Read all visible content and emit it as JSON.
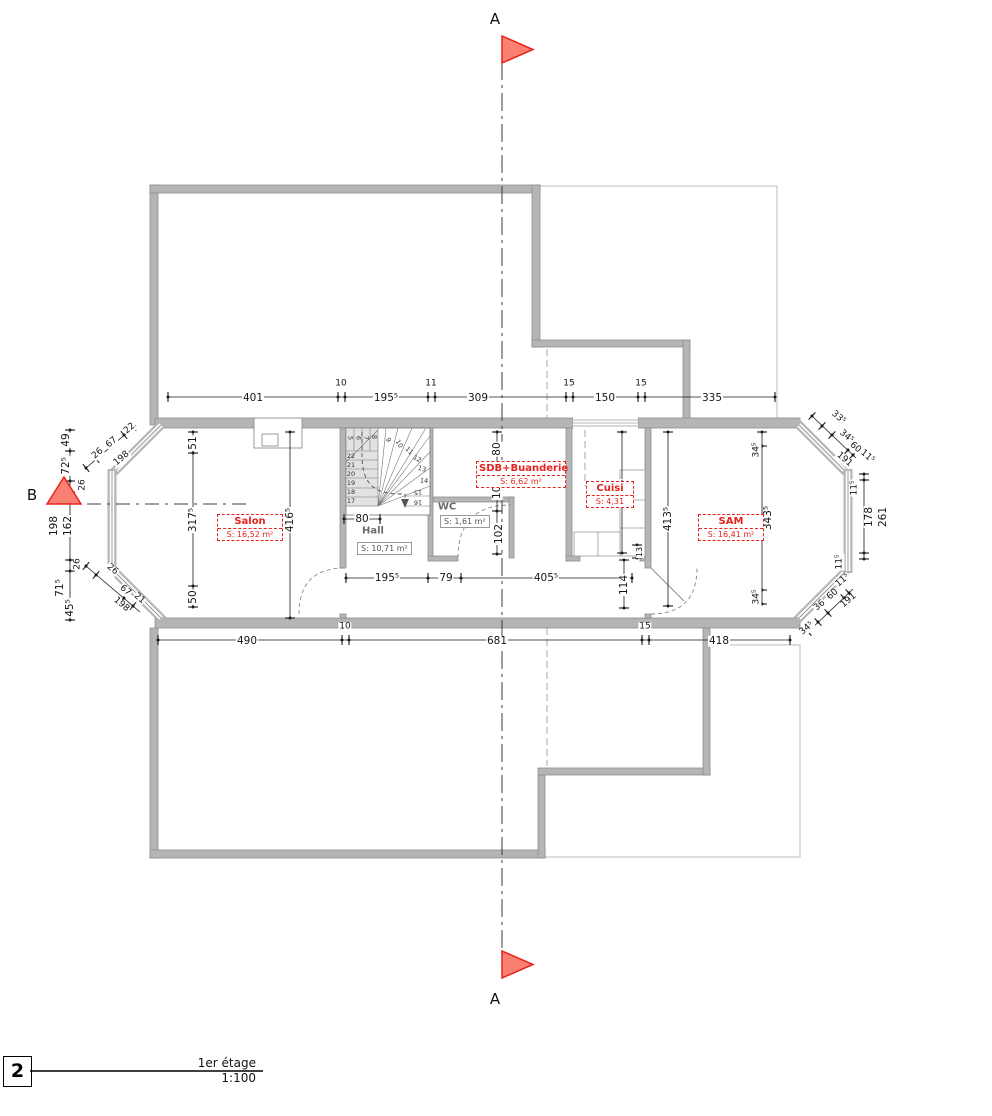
{
  "section_markers": {
    "a_top": "A",
    "a_bottom": "A",
    "b_left": "B"
  },
  "title_block": {
    "index": "2",
    "name": "1er étage",
    "scale": "1:100"
  },
  "rooms": {
    "salon": {
      "name": "Salon",
      "area": "S: 16,52 m²"
    },
    "hall": {
      "name": "Hall",
      "area": "S: 10,71 m²"
    },
    "wc": {
      "name": "WC",
      "area": "S: 1,61 m²"
    },
    "sdb": {
      "name": "SDB+Buanderie",
      "area": "S: 6,62 m²"
    },
    "cuisine": {
      "name": "Cuisi",
      "area": "S: 4,31"
    },
    "sam": {
      "name": "SAM",
      "area": "S: 16,41 m²"
    }
  },
  "dims": {
    "top": {
      "d401": "401",
      "d10": "10",
      "d195": "195⁵",
      "d11": "11",
      "d309": "309",
      "d15a": "15",
      "d150": "150",
      "d15b": "15",
      "d335": "335"
    },
    "bottom": {
      "d490": "490",
      "d10": "10",
      "d681": "681",
      "d15": "15",
      "d418": "418"
    },
    "left_chain": {
      "d49": "49",
      "d72": "72⁵",
      "d26a": "26",
      "d162": "162",
      "d198": "198",
      "d26b": "26",
      "d71": "71⁵",
      "d45": "45⁵"
    },
    "left_diag_top": {
      "d26": "26",
      "d67": "67",
      "d22": "22",
      "d198": "198"
    },
    "left_diag_bottom": {
      "d26": "26",
      "d67": "67",
      "d21": "21",
      "d198": "198"
    },
    "interior_left": {
      "d51": "51",
      "d317": "317⁵",
      "d50": "50",
      "d416": "416⁵"
    },
    "stair": {
      "d80": "80"
    },
    "wc_chain": {
      "d80": "80",
      "d107": "107",
      "d102": "102"
    },
    "hall_chain": {
      "d195": "195⁵",
      "d79": "79",
      "d405": "405⁵"
    },
    "cuisine_chain": {
      "d286": "286⁵",
      "d13": "13",
      "d114": "114"
    },
    "sam_chains": {
      "d413": "413⁵",
      "d343": "343⁵",
      "d34top": "34⁵",
      "d34bottom": "34⁵"
    },
    "right_diag_top": {
      "d33": "33⁵",
      "d34": "34⁵",
      "d60": "60",
      "d11": "11⁵",
      "d191": "191"
    },
    "right_chain": {
      "d11top": "11⁵",
      "d178": "178",
      "d261": "261",
      "d11bottom": "11⁵"
    },
    "right_diag_bottom": {
      "d34": "34⁵",
      "d36": "36",
      "d60": "60",
      "d11": "11⁵",
      "d191": "191"
    }
  },
  "stairs": {
    "straight": [
      "22",
      "21",
      "20",
      "19",
      "18",
      "17"
    ],
    "winder": [
      "5",
      "6",
      "7",
      "8",
      "9",
      "10",
      "11",
      "12",
      "13",
      "14",
      "15",
      "16"
    ]
  },
  "colors": {
    "accent_red": "#e8231d",
    "flag_fill": "#fa8072",
    "wall_gray": "#b5b5b5",
    "dim": "#1a1a1a"
  }
}
